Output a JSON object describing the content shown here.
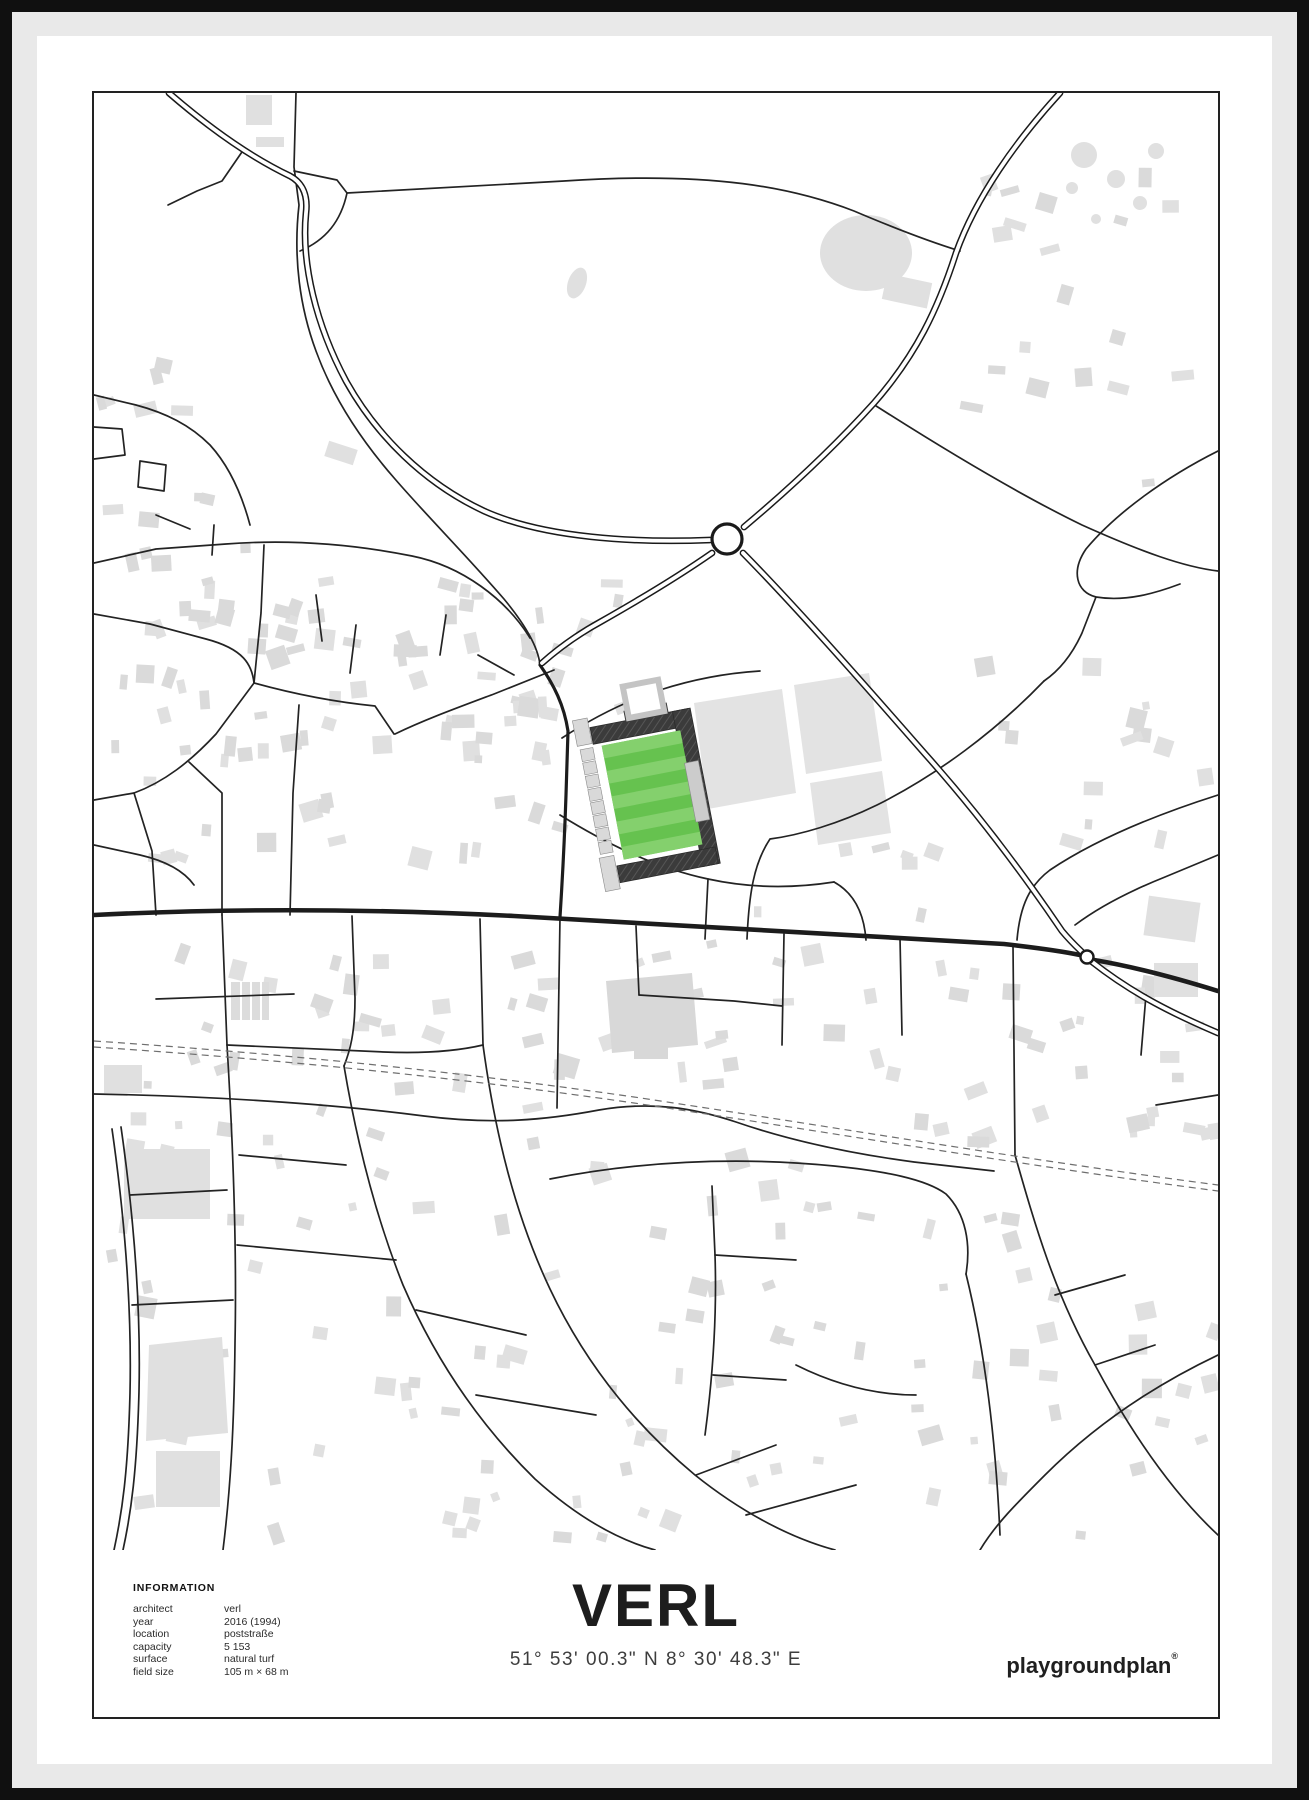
{
  "poster": {
    "title": "VERL",
    "coordinates": "51° 53' 00.3\" N 8° 30' 48.3\" E",
    "brand": "playgroundplan",
    "brand_mark": "®",
    "info": {
      "heading": "INFORMATION",
      "rows": [
        {
          "label": "architect",
          "value": "verl"
        },
        {
          "label": "year",
          "value": "2016 (1994)"
        },
        {
          "label": "location",
          "value": "poststraße"
        },
        {
          "label": "capacity",
          "value": "5 153"
        },
        {
          "label": "surface",
          "value": "natural turf"
        },
        {
          "label": "field size",
          "value": "105 m × 68 m"
        }
      ]
    },
    "colors": {
      "pitch_green": "#66c24f",
      "pitch_stripe": "#84d06d",
      "stand_dark": "#3b3b3b",
      "building_grey": "#e0e0e0",
      "road_black": "#1c1c1c",
      "railway_grey": "#6f6f6f"
    }
  }
}
